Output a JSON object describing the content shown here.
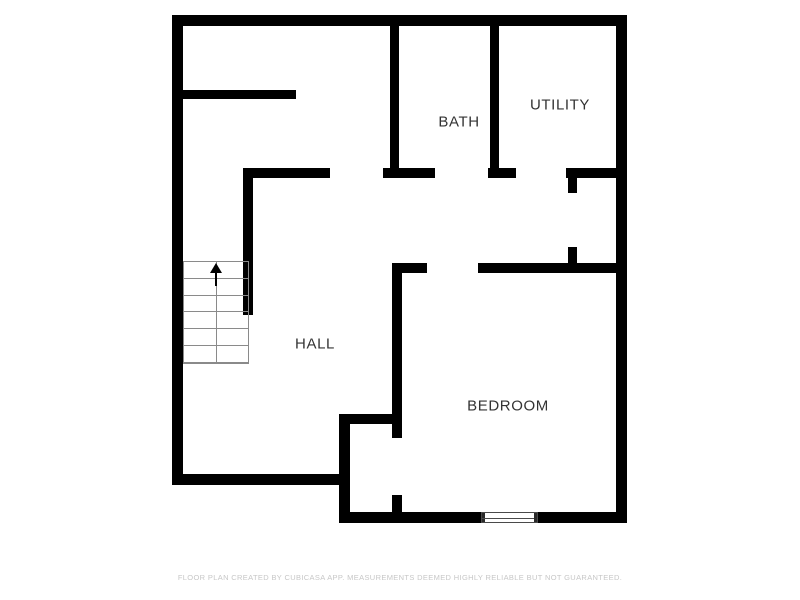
{
  "plan": {
    "wall_color": "#000000",
    "label_color": "#333333",
    "rooms": [
      {
        "id": "bath",
        "label": "BATH"
      },
      {
        "id": "utility",
        "label": "UTILITY"
      },
      {
        "id": "hall",
        "label": "HALL"
      },
      {
        "id": "bedroom",
        "label": "BEDROOM"
      }
    ],
    "stairs": {
      "steps": 6,
      "direction": "up"
    },
    "windows": [
      {
        "id": "bedroom-window",
        "wall": "bedroom-bottom"
      }
    ]
  },
  "footer": {
    "disclaimer": "FLOOR PLAN CREATED BY CUBICASA APP. MEASUREMENTS DEEMED HIGHLY RELIABLE BUT NOT GUARANTEED."
  }
}
